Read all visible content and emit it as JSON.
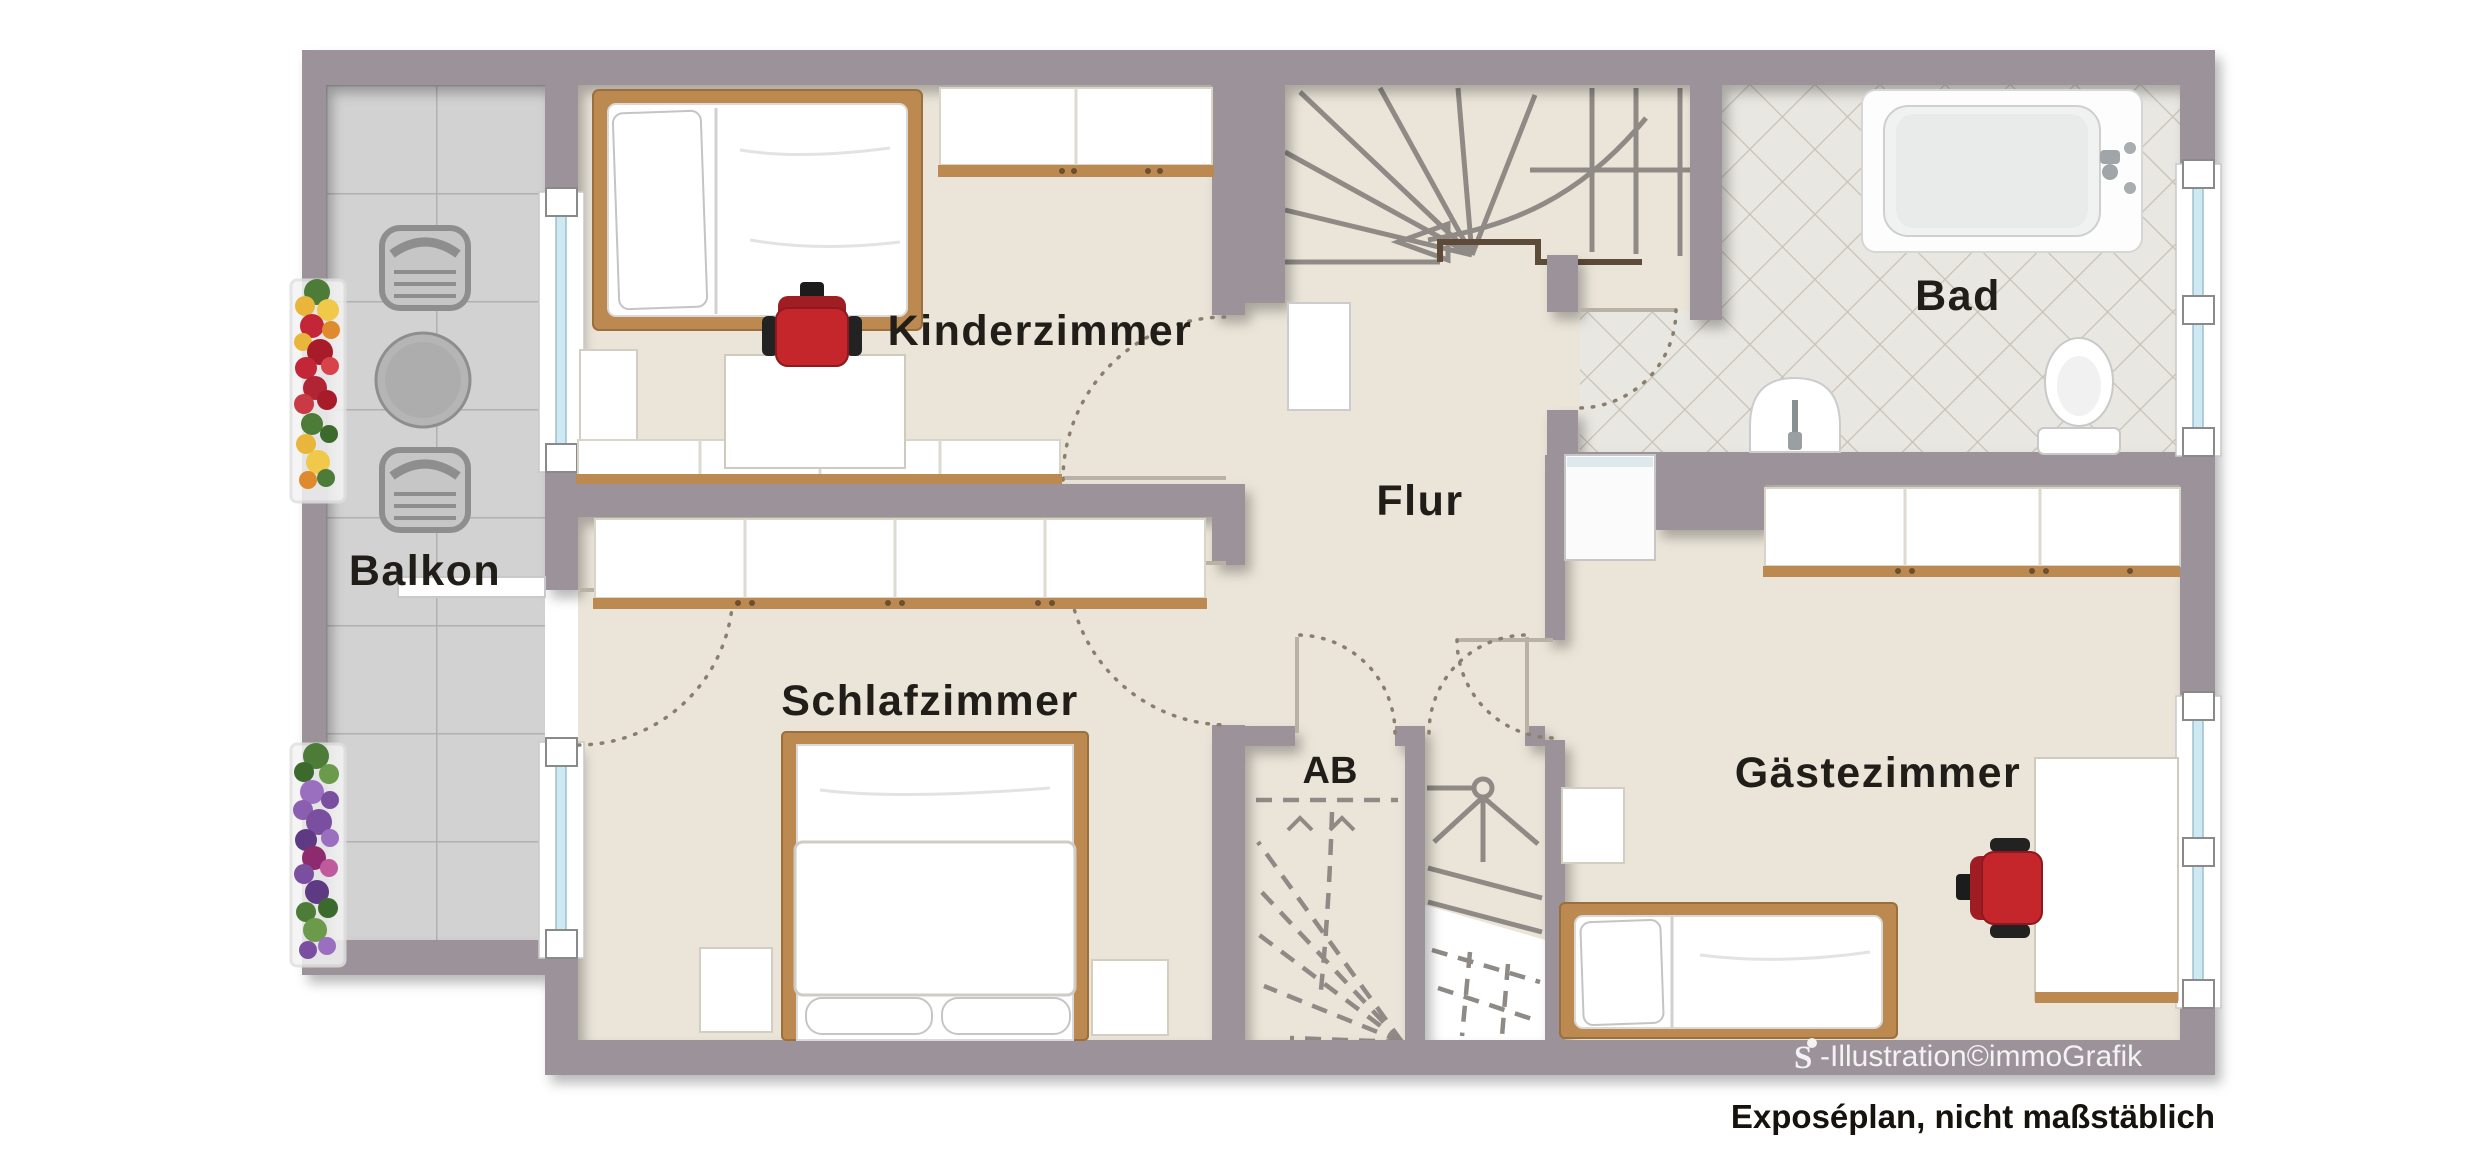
{
  "rooms": {
    "kinderzimmer": {
      "label": "Kinderzimmer"
    },
    "schlafzimmer": {
      "label": "Schlafzimmer"
    },
    "balkon": {
      "label": "Balkon"
    },
    "flur": {
      "label": "Flur"
    },
    "ab": {
      "label": "AB"
    },
    "bad": {
      "label": "Bad"
    },
    "gaestezimmer": {
      "label": "Gästezimmer"
    }
  },
  "footer": {
    "logo_letter": "S",
    "credit": "-Illustration©immoGrafik",
    "disclaimer": "Exposéplan, nicht maßstäblich"
  },
  "colors": {
    "wall": "#9c9299",
    "floor": "#ebe5d9",
    "balcony_tile": "#d2d2d2",
    "bath_tile": "#e9e7e1",
    "window_glass": "#cfe9f2",
    "wood": "#bc8a50",
    "chair_red": "#c4262c",
    "stair_line": "#8f8a86",
    "door_swing": "#8a7e6e",
    "label_text": "#211d18"
  }
}
